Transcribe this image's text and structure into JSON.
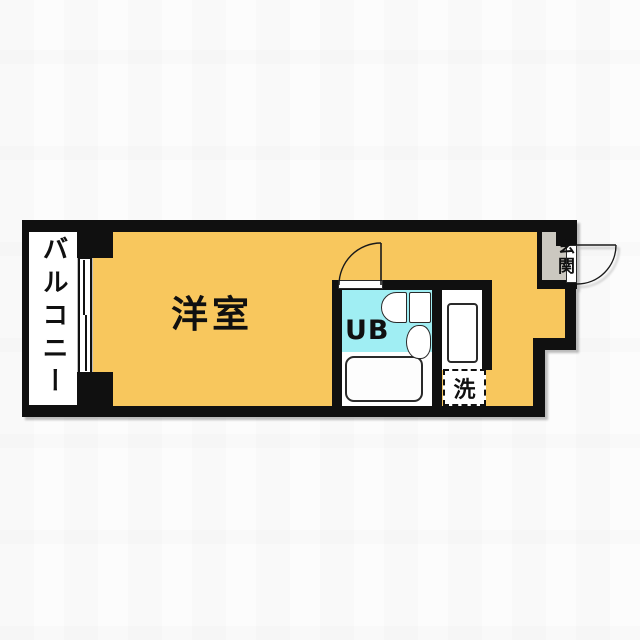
{
  "plan": {
    "type": "apartment-floor-plan",
    "labels": {
      "balcony": "バルコニー",
      "western_room": "洋室",
      "unit_bath": "UB",
      "laundry": "洗",
      "entrance": "玄関"
    },
    "colors": {
      "floor": "#F8C75D",
      "bath": "#A0EEF3",
      "entrance": "#CBC8C0",
      "wall": "#101010",
      "background": "#FCFCFC"
    }
  }
}
